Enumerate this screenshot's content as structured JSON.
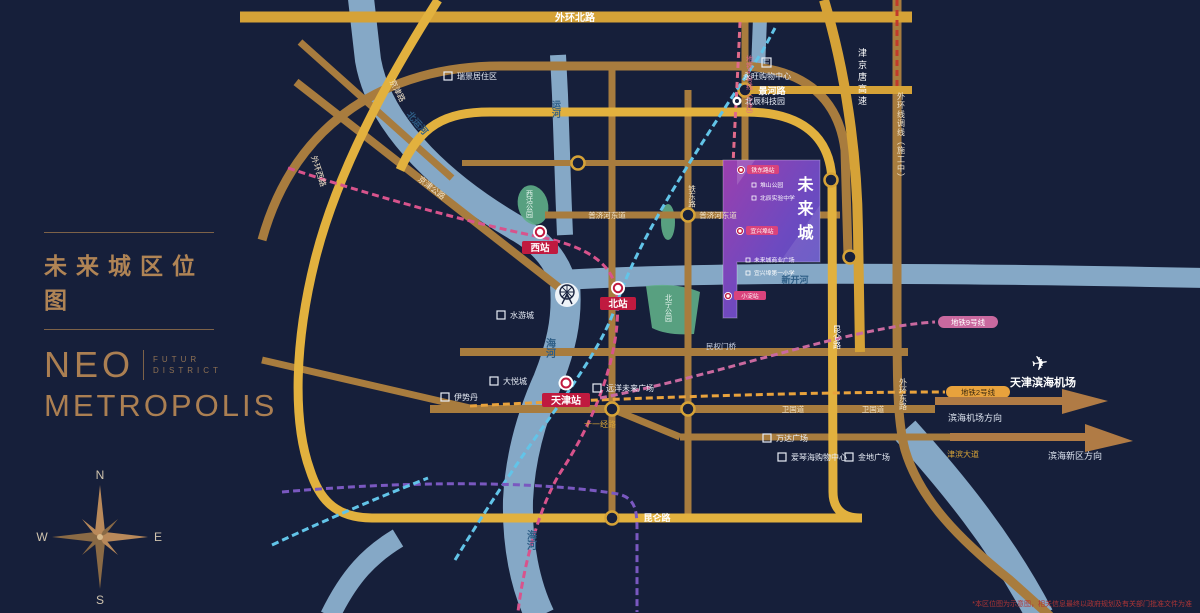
{
  "left_panel": {
    "title": "未来城区位图",
    "brand_line1": "NEO",
    "brand_sub1": "FUTUR",
    "brand_sub2": "DISTRICT",
    "brand_line2": "METROPOLIS",
    "compass": {
      "n": "N",
      "e": "E",
      "s": "S",
      "w": "W"
    }
  },
  "colors": {
    "background": "#161f3a",
    "accent_bronze": "#ab7f52",
    "road_gold": "#d5a237",
    "road_brown": "#a87c3e",
    "river_blue": "#8fb4d2",
    "block_purple": "#8a3fae",
    "badge_red": "#c01a3f"
  },
  "map": {
    "roads": {
      "waihuan_north": "外环北路",
      "jinghe_road": "景河路",
      "jjtang_expwy": "津京唐高速",
      "waihuan_reroute": "外环线调线（施工中）",
      "waihuan_east": "外环东路",
      "waihuan_west": "外环西路",
      "kunlun_south": "昆仑路",
      "kunlun_east": "昆仑路",
      "jingjin_road": "京津路",
      "jingjin_highway": "京津公路",
      "pujihe_east_1": "普济河东道",
      "pujihe_east_2": "普济河东道",
      "tiedong_road": "铁东路",
      "minquanmen": "民权门桥",
      "weiguo_1": "卫国道",
      "weiguo_2": "卫国道",
      "shiyijing_road": "十一经路",
      "jinbin_avenue": "津滨大道"
    },
    "rivers": {
      "beiyunhe": "北运河",
      "yunhe": "运河",
      "haihe_1": "海河",
      "haihe_2": "海河",
      "xinkaihe": "新开河"
    },
    "stations": {
      "west": "西站",
      "north": "北站",
      "tianjin": "天津站"
    },
    "metro": {
      "line2": "地铁2号线",
      "line9": "地铁9号线",
      "line4": "地铁4号线（在建）"
    },
    "pois": {
      "aeon": "永旺购物中心",
      "bc_tech": "北辰科技园",
      "ruijing": "瑞景居住区",
      "xigu_park": "西沽公园",
      "beining_park": "北宁公园",
      "shuiyoucheng": "水游城",
      "joy_city": "大悦城",
      "isetan": "伊势丹",
      "yuanyang_plaza": "远洋未来广场",
      "wanda": "万达广场",
      "aegean": "爱琴海购物中心",
      "jindi": "金地广场",
      "airport": "天津滨海机场"
    },
    "directions": {
      "to_airport": "滨海机场方向",
      "to_binhai": "滨海新区方向"
    },
    "future_city": {
      "name": "未来城",
      "stations": [
        "铁东路站",
        "宜兴埠站",
        "小淀站"
      ],
      "items": [
        "堆山公园",
        "北辰实验中学",
        "未来城商业广场",
        "宜兴埠第一小学"
      ]
    },
    "disclaimer": "*本区位图为示意图，相关信息最终以政府规划及有关部门批准文件为准"
  }
}
